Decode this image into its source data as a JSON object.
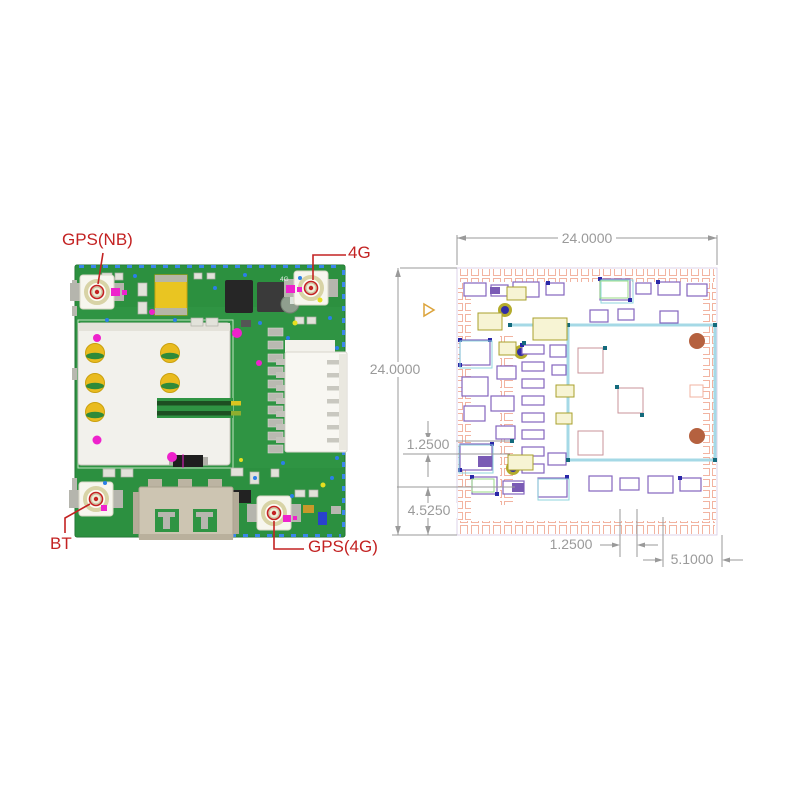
{
  "photo": {
    "labels": {
      "gps_nb": "GPS(NB)",
      "cell_4g": "4G",
      "bt": "BT",
      "gps_4g": "GPS(4G)"
    },
    "silkscreen_4g": "4G",
    "annotation_color": "#c32222",
    "board_color": "#2f9443"
  },
  "cad": {
    "dimension_color": "#9a9a9a",
    "dimensions": {
      "top_width": "24.0000",
      "left_height": "24.0000",
      "left_gap": "1.2500",
      "left_offset": "4.5250",
      "bottom_gap": "1.2500",
      "bottom_offset": "5.1000"
    },
    "colors": {
      "edge_pad": "#f2b3a0",
      "component_outline": "#8465bd",
      "shield_outline": "#a5d9e6",
      "via_ring": "#b3ab2c",
      "via_core": "#312da5",
      "mount_hole": "#b5613f"
    }
  }
}
